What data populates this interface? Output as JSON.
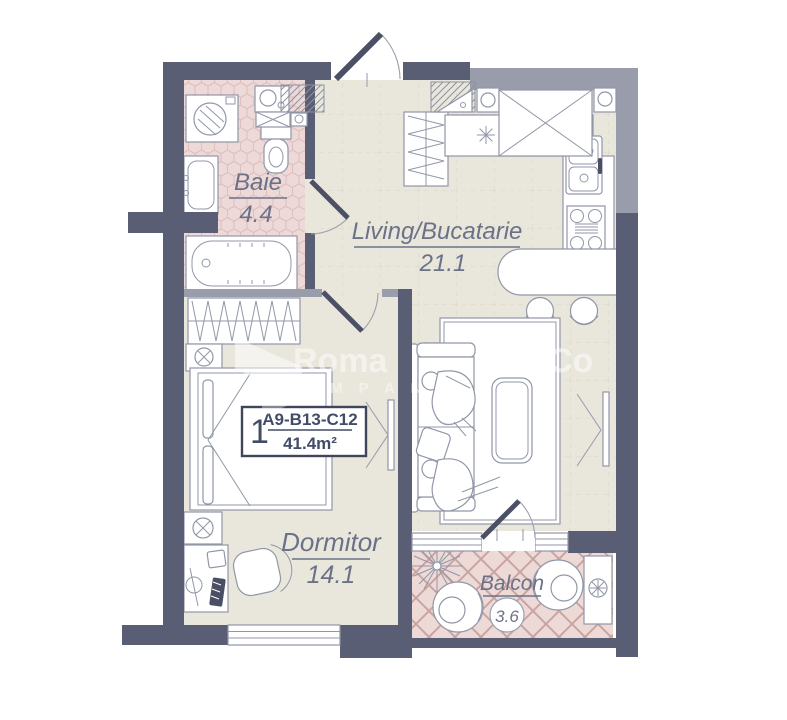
{
  "unit_label": {
    "number": "1",
    "code": "A9-B13-C12",
    "area": "41.4m²"
  },
  "rooms": {
    "baie": {
      "name": "Baie",
      "area": "4.4"
    },
    "living": {
      "name": "Living/Bucatarie",
      "area": "21.1"
    },
    "dormitor": {
      "name": "Dormitor",
      "area": "14.1"
    },
    "balcon": {
      "name": "Balcon",
      "area": "3.6"
    }
  },
  "kitchen": {
    "appliance_mark": "N"
  },
  "watermark": {
    "fragment1": "Roma",
    "fragment2": "Co",
    "line2": "M P A N I"
  },
  "fixtures": [
    "washing-machine",
    "bathroom-vanity-sink",
    "toilet",
    "bathtub",
    "ventilation-shaft",
    "coat-closet",
    "kitchen-counter",
    "extractor-hood",
    "oven",
    "kitchen-sink",
    "stove",
    "bar-counter",
    "bar-stool",
    "sofa",
    "person-figure",
    "pillow",
    "rug",
    "coffee-table",
    "tv",
    "wardrobe",
    "bed",
    "nightstand",
    "desk",
    "desk-chair",
    "entrance-door",
    "bathroom-door",
    "bedroom-door",
    "balcony-door",
    "window",
    "plant",
    "balcony-armchair",
    "ac-unit"
  ],
  "colors": {
    "wall_dark": "#5a5e74",
    "wall_light": "#989cab",
    "floor_living": "#e9e6dc",
    "floor_bath": "#ecd9d8",
    "floor_balcony": "#edd9d6",
    "line": "#9197a7",
    "label_text": "#6b7288",
    "unit_text": "#414d66",
    "tile_hex": "#ddbfbe",
    "tile_diamond": "#c9a4a2",
    "grid": "#d9d5c7",
    "door": "#4b5065"
  }
}
